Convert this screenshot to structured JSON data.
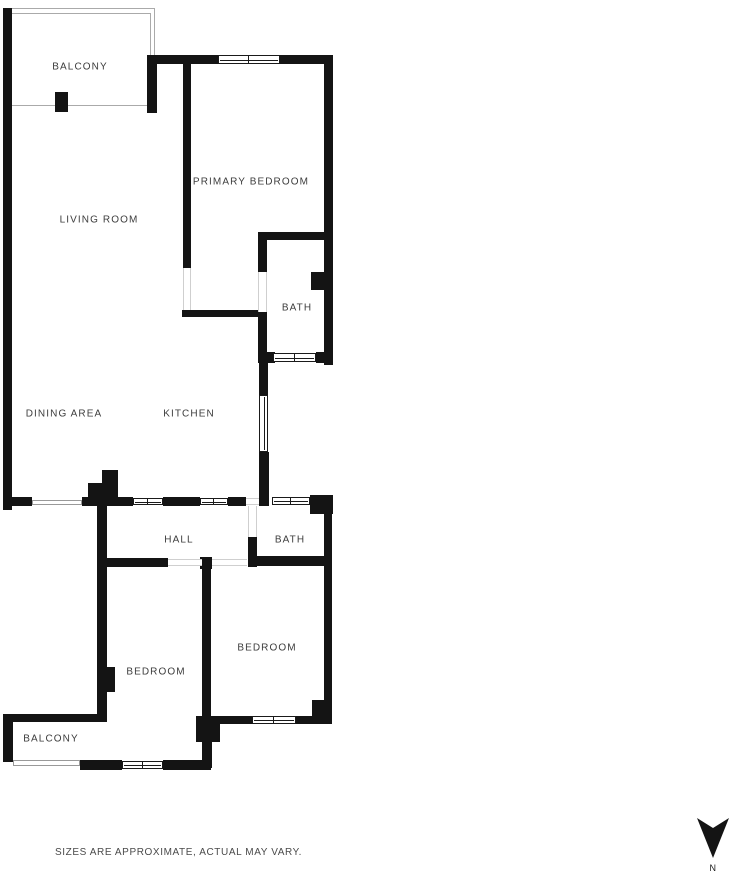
{
  "plan": {
    "room_labels": [
      {
        "id": "balcony-top",
        "label": "BALCONY"
      },
      {
        "id": "primary-bedroom",
        "label": "PRIMARY BEDROOM"
      },
      {
        "id": "living-room",
        "label": "LIVING ROOM"
      },
      {
        "id": "bath-top",
        "label": "BATH"
      },
      {
        "id": "dining-area",
        "label": "DINING AREA"
      },
      {
        "id": "kitchen",
        "label": "KITCHEN"
      },
      {
        "id": "hall",
        "label": "HALL"
      },
      {
        "id": "bath-bottom",
        "label": "BATH"
      },
      {
        "id": "bedroom-right",
        "label": "BEDROOM"
      },
      {
        "id": "bedroom-left",
        "label": "BEDROOM"
      },
      {
        "id": "balcony-bottom",
        "label": "BALCONY"
      }
    ],
    "footer_note": "SIZES ARE APPROXIMATE, ACTUAL MAY VARY.",
    "compass": {
      "label": "N"
    },
    "colors": {
      "wall": "#141414",
      "label_text": "#3c3c3c",
      "footer_text": "#4a4a4a",
      "window_border": "#1a1a1a",
      "balcony_outline": "#aaaaaa",
      "door_threshold": "#cfcfcf",
      "background": "#ffffff"
    }
  }
}
